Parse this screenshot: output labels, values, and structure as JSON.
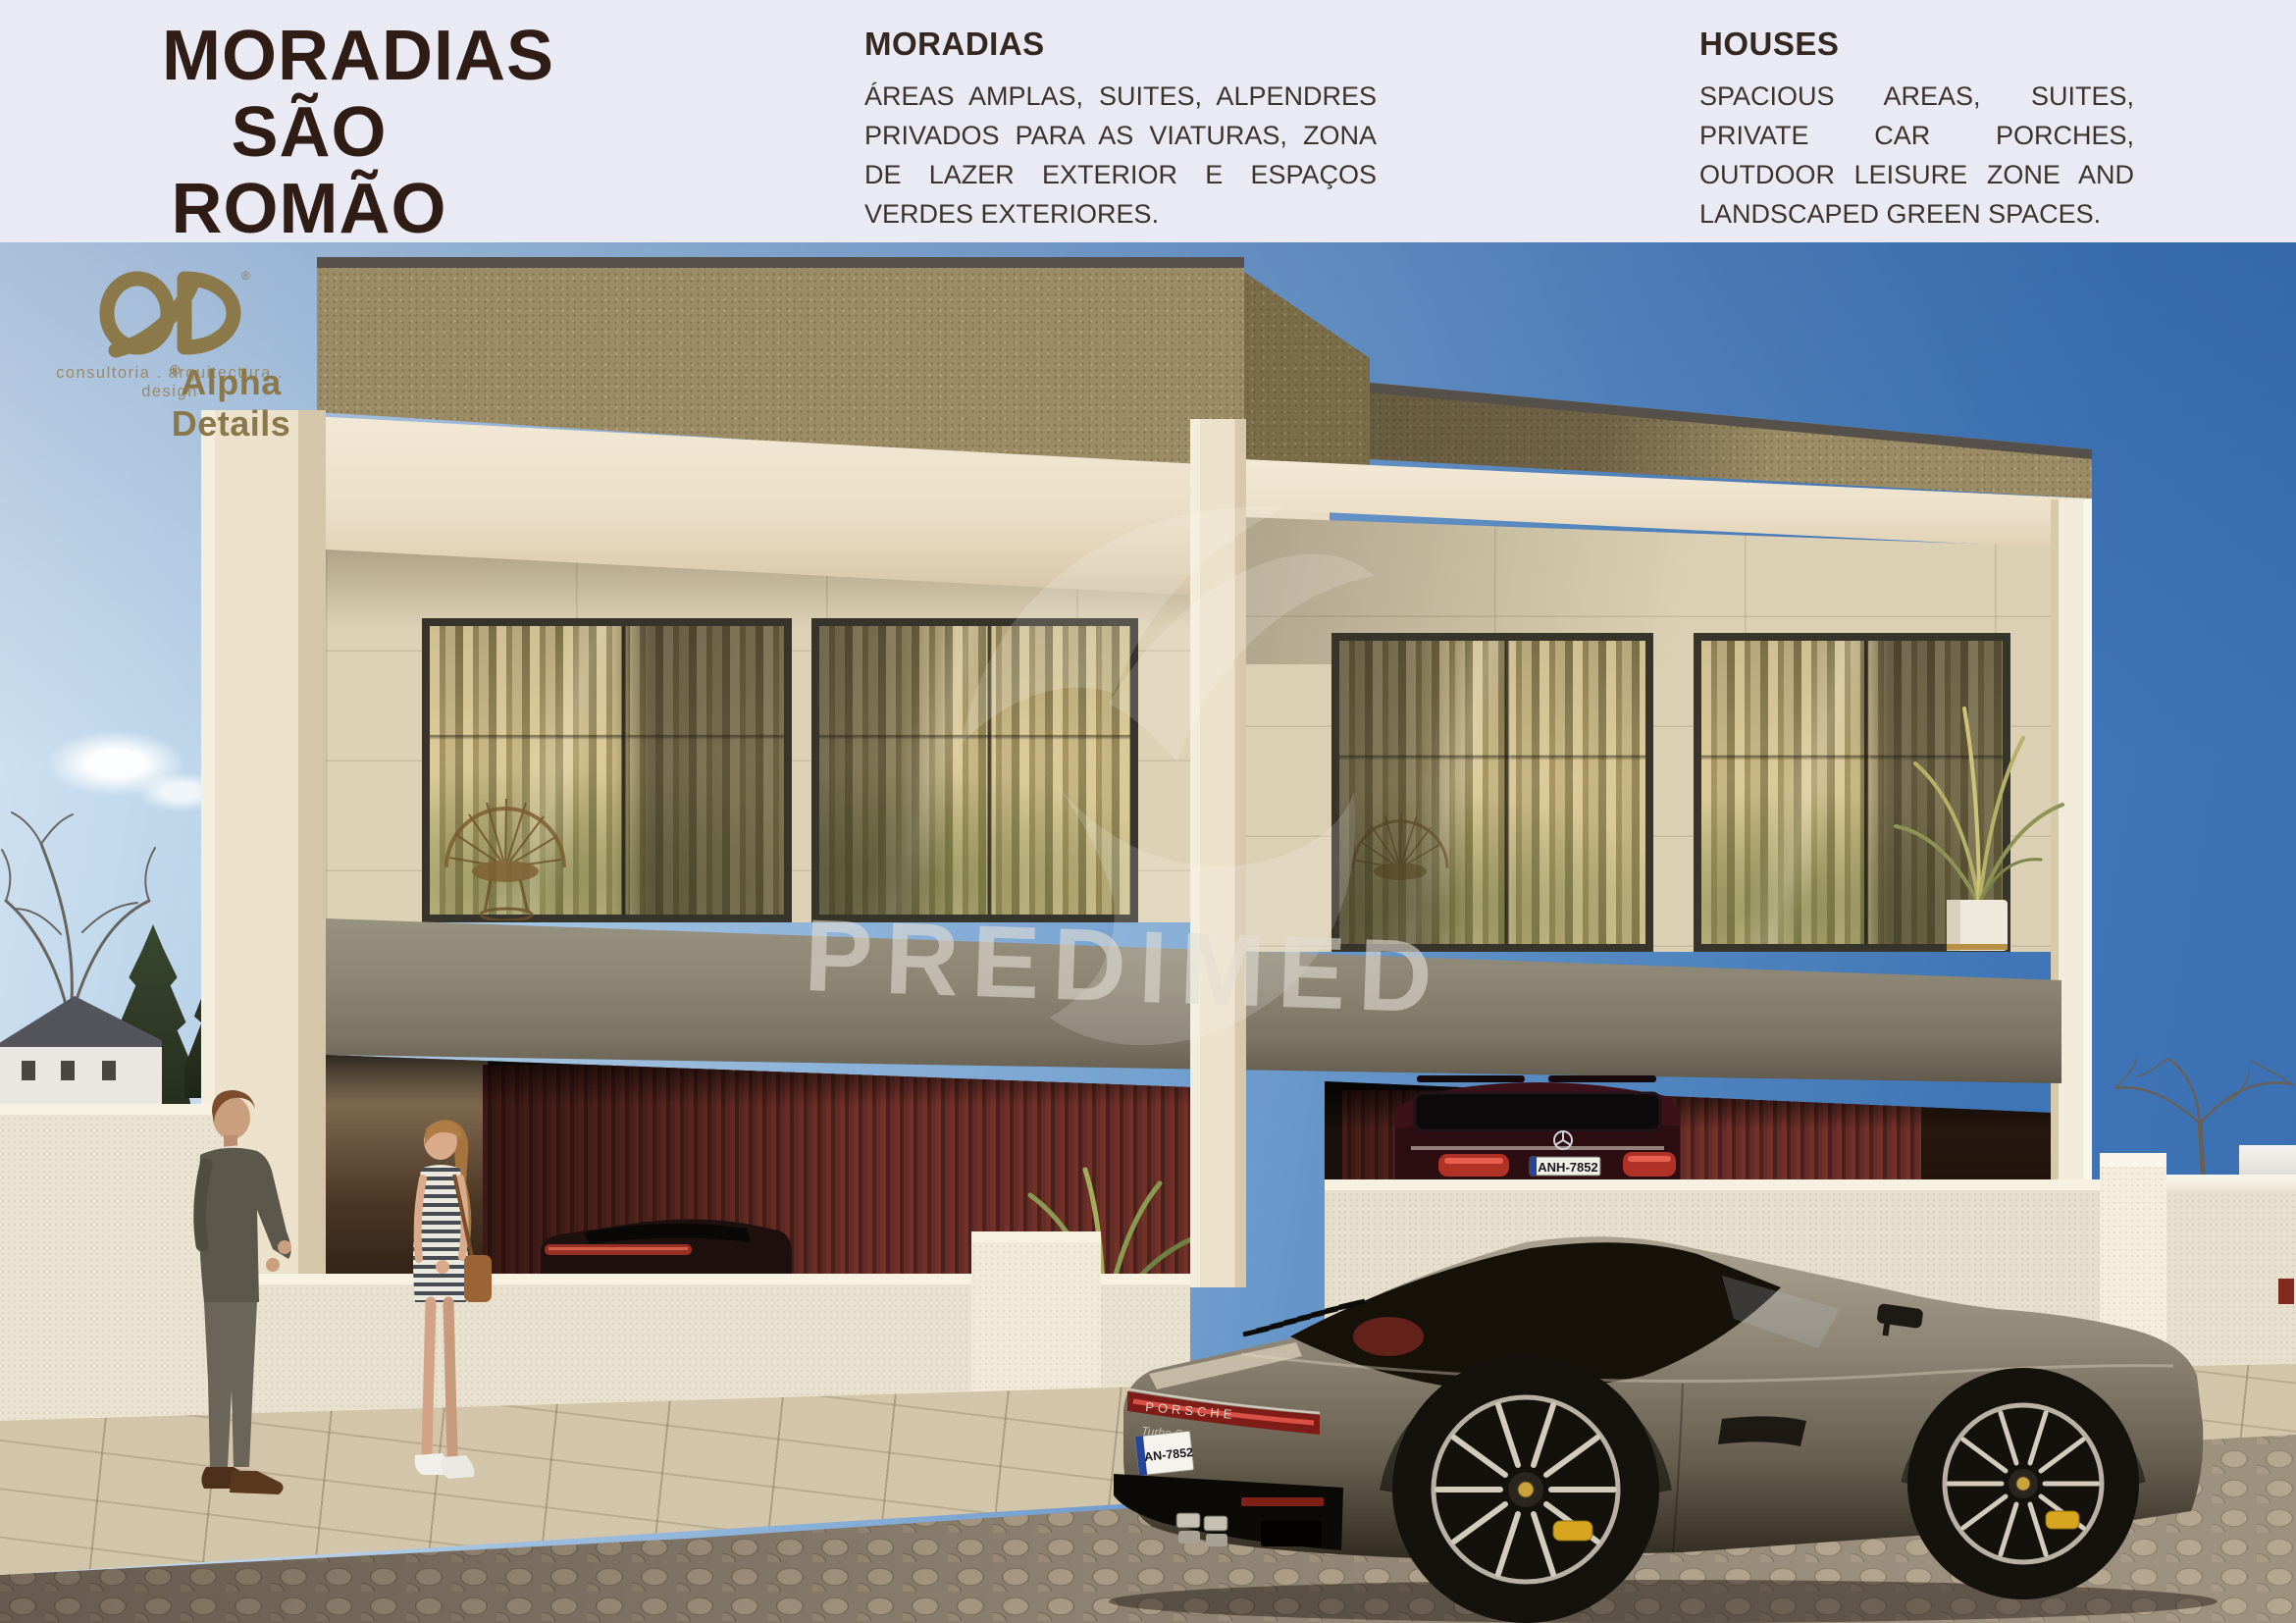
{
  "header": {
    "title": {
      "line1": "MORADIAS",
      "line2": "SÃO",
      "line3": "ROMÃO"
    },
    "pt": {
      "heading": "MORADIAS",
      "body": "ÁREAS AMPLAS, SUITES, ALPENDRES PRIVADOS PARA AS VIATURAS, ZONA DE LAZER EXTERIOR E ESPAÇOS VERDES EXTERIORES."
    },
    "en": {
      "heading": "HOUSES",
      "body": "SPACIOUS AREAS, SUITES, PRIVATE CAR PORCHES, OUTDOOR LEISURE ZONE AND LANDSCAPED GREEN SPACES."
    }
  },
  "branding": {
    "name": "Alpha Details",
    "registered": "®",
    "tagline": "consultoria . arquitectura . design",
    "color": "#8c794a"
  },
  "watermark": {
    "text": "PREDIMED"
  },
  "vehicles": {
    "porsche_badge": "PORSCHE",
    "porsche_model": "Turbo S",
    "porsche_plate": "AN-7852",
    "suv_plate": "ANH-7852"
  },
  "palette": {
    "header_bg": "#e9eaf4",
    "title_brown": "#2f1d15",
    "sky_deep": "#3a6fb2",
    "sky_light": "#d3e4f2",
    "facade_cream": "#ece1cb",
    "parapet_khaki": "#9c8c65",
    "limestone": "#ded2b6",
    "balcony_band": "#8b8472",
    "garage_red": "#6e3129",
    "fence": "#ebe3d2",
    "sidewalk": "#d3c5a9",
    "cobbles": "#8d8171"
  }
}
